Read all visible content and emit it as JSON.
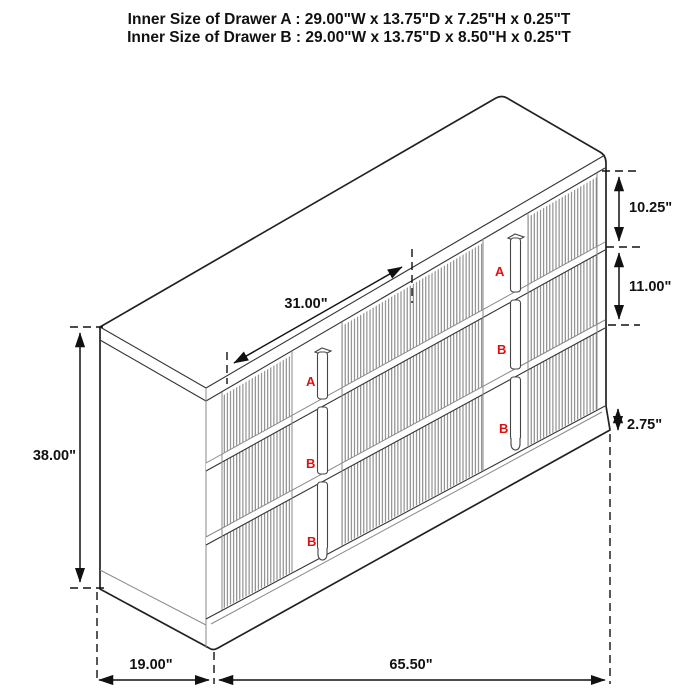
{
  "title": {
    "line1": "Inner Size of Drawer A : 29.00\"W x 13.75\"D x 7.25\"H x 0.25\"T",
    "line2": "Inner Size of Drawer B : 29.00\"W x 13.75\"D x 8.50\"H x 0.25\"T"
  },
  "dimensions": {
    "overall_height": "38.00\"",
    "overall_depth": "19.00\"",
    "overall_width": "65.50\"",
    "drawer_front_width": "31.00\"",
    "drawer_a_front_height": "10.25\"",
    "drawer_b_front_height": "11.00\"",
    "base_height": "2.75\""
  },
  "drawer_labels": {
    "left_stack": [
      "A",
      "B",
      "B"
    ],
    "right_stack": [
      "A",
      "B",
      "B"
    ]
  },
  "colors": {
    "line": "#1c1c1c",
    "flute": "#7a7a7a",
    "label_red": "#dd1111",
    "background": "#ffffff"
  }
}
